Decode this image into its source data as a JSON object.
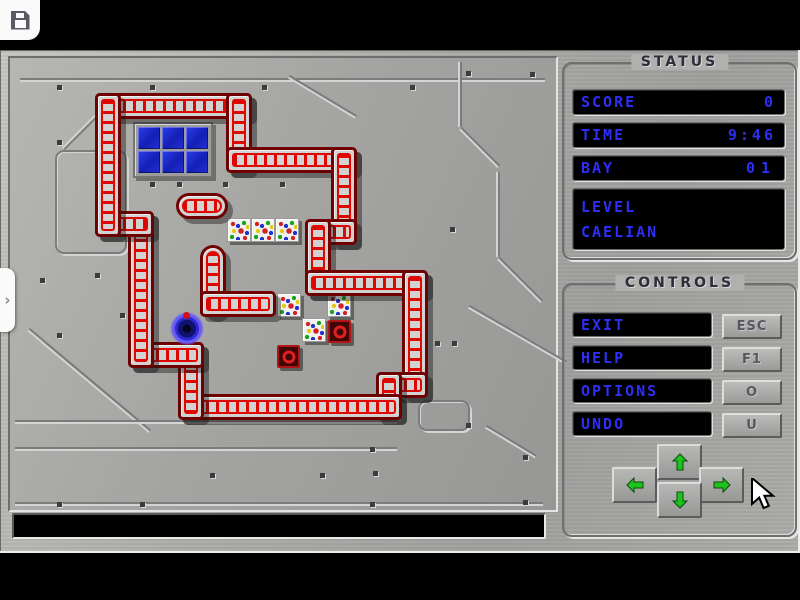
{
  "toolbar": {
    "save_icon": "floppy-disk"
  },
  "side_tab": {
    "chevron": "›"
  },
  "status": {
    "title": "STATUS",
    "rows": [
      {
        "label": "SCORE",
        "value": "0"
      },
      {
        "label": "TIME",
        "value": "9:46"
      },
      {
        "label": "BAY",
        "value": "01"
      }
    ],
    "level": {
      "label": "LEVEL",
      "name": "CAELIAN"
    }
  },
  "controls": {
    "title": "CONTROLS",
    "buttons": [
      {
        "label": "EXIT",
        "key": "ESC"
      },
      {
        "label": "HELP",
        "key": "F1"
      },
      {
        "label": "OPTIONS",
        "key": "O"
      },
      {
        "label": "UNDO",
        "key": "U"
      }
    ],
    "arrows": [
      "up",
      "left",
      "right",
      "down"
    ]
  },
  "message_bar": {
    "text": ""
  },
  "colors": {
    "text_blue": "#2e2ef5",
    "wall_red": "#de0800",
    "wall_border": "#6e0202",
    "metal_gray": "#ababa9",
    "window_blue": "#1c2cd8",
    "target_red": "#c41616",
    "player_glow": "#6a5af5",
    "arrow_green": "#1ec21e",
    "title_dark": "#2e2e3a"
  },
  "board": {
    "walls": [
      {
        "x": 95,
        "y": 43,
        "w": 157,
        "h": 26,
        "o": "h"
      },
      {
        "x": 226,
        "y": 43,
        "w": 26,
        "h": 80,
        "o": "v"
      },
      {
        "x": 226,
        "y": 97,
        "w": 131,
        "h": 26,
        "o": "h"
      },
      {
        "x": 331,
        "y": 97,
        "w": 26,
        "h": 98,
        "o": "v"
      },
      {
        "x": 305,
        "y": 169,
        "w": 52,
        "h": 26,
        "o": "h"
      },
      {
        "x": 305,
        "y": 169,
        "w": 26,
        "h": 77,
        "o": "v"
      },
      {
        "x": 305,
        "y": 220,
        "w": 123,
        "h": 26,
        "o": "h"
      },
      {
        "x": 402,
        "y": 220,
        "w": 26,
        "h": 128,
        "o": "v"
      },
      {
        "x": 376,
        "y": 322,
        "w": 52,
        "h": 26,
        "o": "h"
      },
      {
        "x": 376,
        "y": 322,
        "w": 26,
        "h": 48,
        "o": "v"
      },
      {
        "x": 178,
        "y": 344,
        "w": 224,
        "h": 26,
        "o": "h"
      },
      {
        "x": 178,
        "y": 292,
        "w": 26,
        "h": 78,
        "o": "v"
      },
      {
        "x": 128,
        "y": 292,
        "w": 76,
        "h": 26,
        "o": "h"
      },
      {
        "x": 128,
        "y": 161,
        "w": 26,
        "h": 157,
        "o": "v"
      },
      {
        "x": 95,
        "y": 161,
        "w": 59,
        "h": 26,
        "o": "h"
      },
      {
        "x": 95,
        "y": 43,
        "w": 26,
        "h": 144,
        "o": "v"
      },
      {
        "x": 176,
        "y": 143,
        "w": 52,
        "h": 26,
        "o": "h",
        "p": true
      },
      {
        "x": 200,
        "y": 195,
        "w": 26,
        "h": 72,
        "o": "v",
        "p": true
      },
      {
        "x": 200,
        "y": 241,
        "w": 76,
        "h": 26,
        "o": "h"
      }
    ],
    "window": {
      "x": 133,
      "y": 72,
      "cols": 3,
      "rows": 2,
      "cell": 22,
      "gap": 2
    },
    "crates": [
      [
        227,
        168
      ],
      [
        251,
        168
      ],
      [
        275,
        168
      ],
      [
        277,
        243
      ],
      [
        327,
        243
      ],
      [
        302,
        268
      ]
    ],
    "targets": [
      [
        328,
        270
      ],
      [
        277,
        295
      ]
    ],
    "player": {
      "x": 170,
      "y": 261,
      "size": 34
    },
    "rivets": [
      [
        57,
        35
      ],
      [
        150,
        35
      ],
      [
        262,
        35
      ],
      [
        410,
        35
      ],
      [
        466,
        21
      ],
      [
        530,
        22
      ],
      [
        57,
        90
      ],
      [
        100,
        90
      ],
      [
        150,
        132
      ],
      [
        177,
        132
      ],
      [
        223,
        132
      ],
      [
        280,
        132
      ],
      [
        40,
        228
      ],
      [
        95,
        223
      ],
      [
        57,
        283
      ],
      [
        120,
        263
      ],
      [
        210,
        423
      ],
      [
        370,
        397
      ],
      [
        373,
        421
      ],
      [
        370,
        452
      ],
      [
        466,
        373
      ],
      [
        523,
        405
      ],
      [
        523,
        450
      ],
      [
        57,
        452
      ],
      [
        140,
        452
      ],
      [
        320,
        423
      ],
      [
        452,
        291
      ],
      [
        435,
        291
      ],
      [
        450,
        177
      ]
    ],
    "lines": [
      {
        "x": 20,
        "y": 28,
        "len": 525,
        "ang": 0
      },
      {
        "x": 120,
        "y": 45,
        "len": 78,
        "ang": 135
      },
      {
        "x": 290,
        "y": 25,
        "len": 78,
        "ang": 31
      },
      {
        "x": 462,
        "y": 12,
        "len": 65,
        "ang": 90
      },
      {
        "x": 462,
        "y": 77,
        "len": 54,
        "ang": 45
      },
      {
        "x": 500,
        "y": 122,
        "len": 85,
        "ang": 90
      },
      {
        "x": 500,
        "y": 207,
        "len": 61,
        "ang": 45
      },
      {
        "x": 470,
        "y": 255,
        "len": 112,
        "ang": 30
      },
      {
        "x": 487,
        "y": 375,
        "len": 58,
        "ang": 31
      },
      {
        "x": 30,
        "y": 278,
        "len": 145,
        "ang": 40
      },
      {
        "x": 44,
        "y": 290,
        "len": 140,
        "ang": 40
      },
      {
        "x": 15,
        "y": 370,
        "len": 382,
        "ang": 0
      },
      {
        "x": 15,
        "y": 397,
        "len": 382,
        "ang": 0
      },
      {
        "x": 15,
        "y": 452,
        "len": 528,
        "ang": 0
      }
    ],
    "rects": [
      {
        "x": 55,
        "y": 100,
        "w": 68,
        "h": 100
      },
      {
        "x": 418,
        "y": 350,
        "w": 48,
        "h": 27
      }
    ]
  }
}
